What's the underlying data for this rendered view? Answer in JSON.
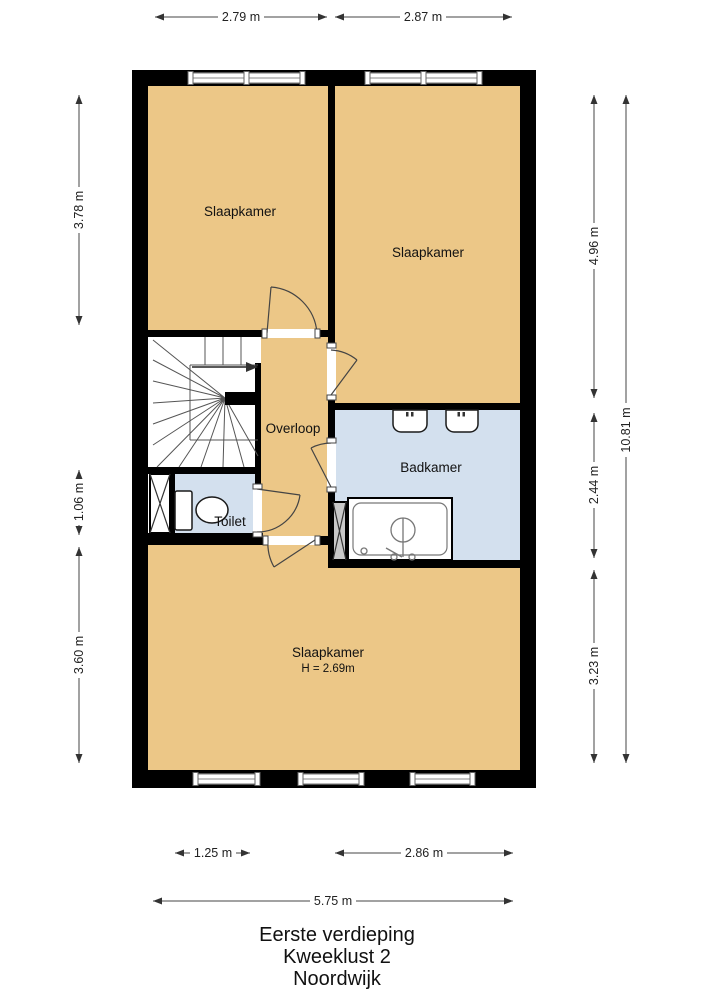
{
  "title": {
    "line1": "Eerste verdieping",
    "line2": "Kweeklust 2",
    "line3": "Noordwijk"
  },
  "rooms": {
    "slaapkamer_top_left": "Slaapkamer",
    "slaapkamer_top_right": "Slaapkamer",
    "overloop": "Overloop",
    "badkamer": "Badkamer",
    "toilet": "Toilet",
    "slaapkamer_bottom": "Slaapkamer",
    "slaapkamer_bottom_height": "H = 2.69m"
  },
  "dimensions": {
    "top": [
      "2.79 m",
      "2.87 m"
    ],
    "left": [
      "3.78 m",
      "1.06 m",
      "3.60 m"
    ],
    "right": [
      "4.96 m",
      "2.44 m",
      "3.23 m"
    ],
    "right_total": "10.81 m",
    "bottom": [
      "1.25 m",
      "2.86 m"
    ],
    "bottom_total": "5.75 m"
  },
  "colors": {
    "wall": "#000000",
    "room_floor": "#ecc787",
    "wet_room_floor": "#d3e0ee",
    "background": "#ffffff"
  }
}
